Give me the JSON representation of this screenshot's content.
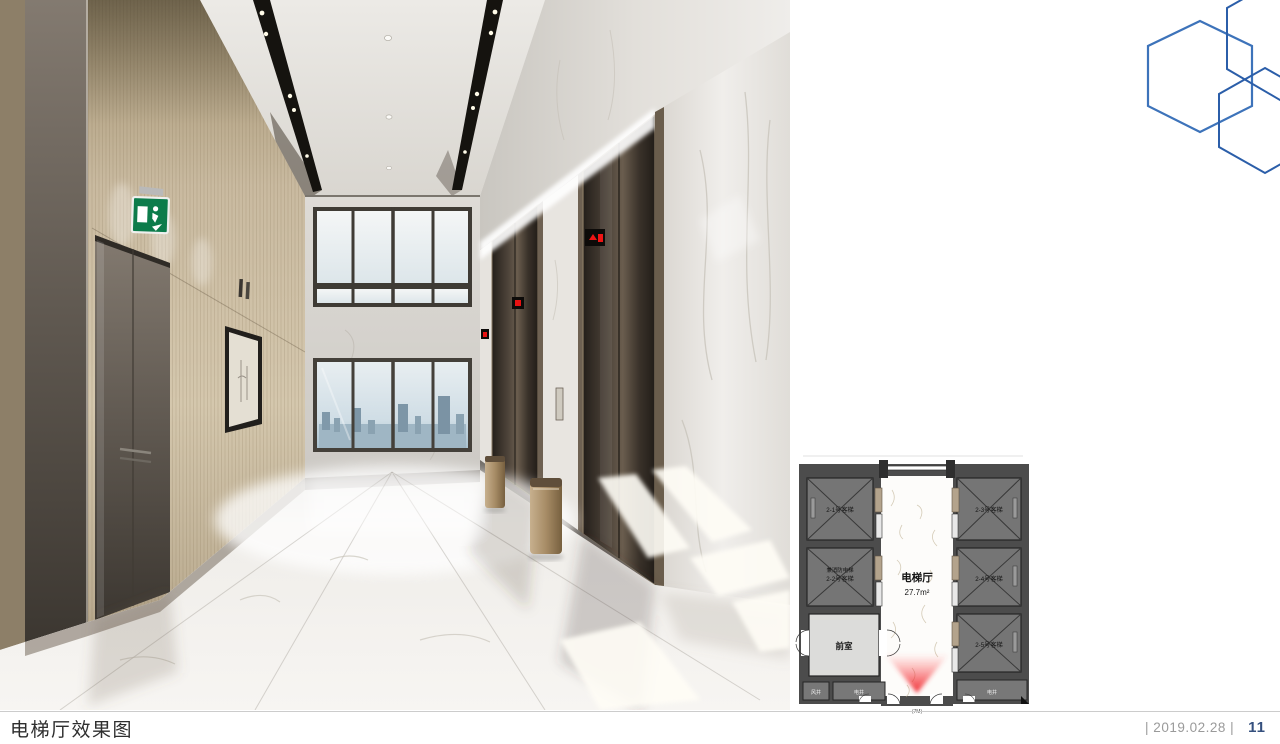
{
  "footer": {
    "caption": "电梯厅效果图",
    "date_text": "| 2019.02.28 |",
    "page_number": "11"
  },
  "floorplan": {
    "hall_label": "电梯厅",
    "hall_area": "27.7m²",
    "vestibule_label": "前室",
    "air_shaft_label": "风井",
    "electric_shaft_left_label": "电井",
    "electric_shaft_right_label": "电井",
    "bottom_note": "(7M)",
    "elevators": {
      "e1": "2-1号客梯",
      "e2_line1": "兼消防电梯",
      "e2_line2": "2-2号客梯",
      "e3": "2-3号客梯",
      "e4": "2-4号客梯",
      "e5": "2-5号客梯"
    }
  },
  "colors": {
    "hexagon_blue": "#3d73ba",
    "hexagon_dark_blue": "#2b5ea9",
    "date_gray": "#9a9a9a",
    "page_number_navy": "#35507e",
    "camera_cone_red": "#ee1c25",
    "exit_sign_green": "#0c7c4b"
  }
}
